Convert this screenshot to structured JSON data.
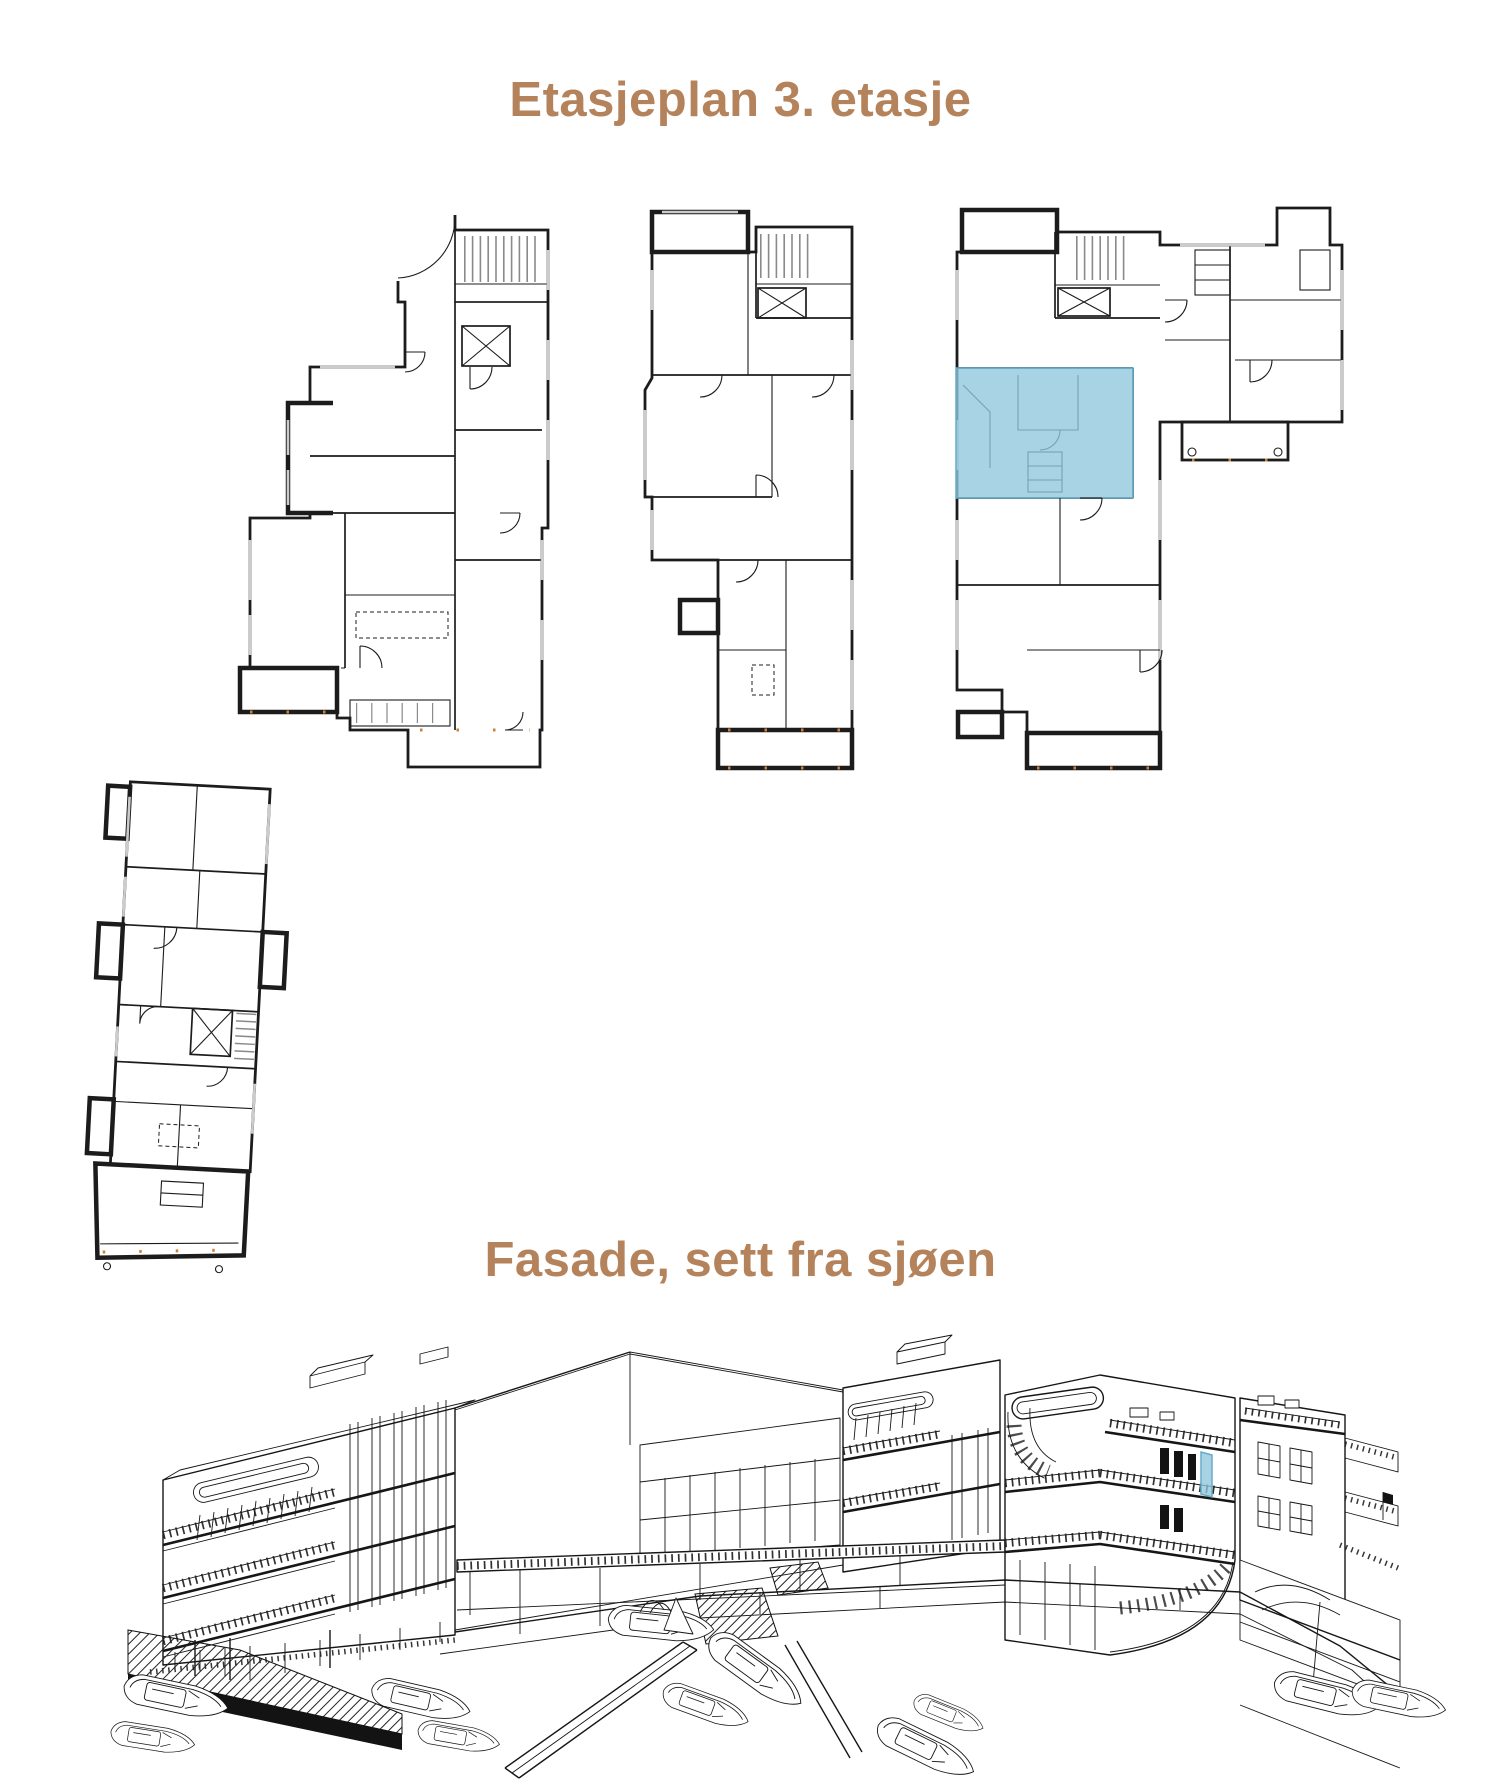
{
  "sections": {
    "floorplan": {
      "title": "Etasjeplan 3. etasje"
    },
    "facade": {
      "title": "Fasade, sett fra sjøen"
    }
  },
  "colors": {
    "title_text": "#b5835b",
    "plan_highlight": "#8ec6dc",
    "plan_highlight_edge": "#68abc6",
    "ink": "#1c1c1c",
    "stair_gray": "#8a8a8a",
    "window_gray": "#cccccc",
    "accent_orange": "#c8823d",
    "page_background": "#ffffff"
  }
}
